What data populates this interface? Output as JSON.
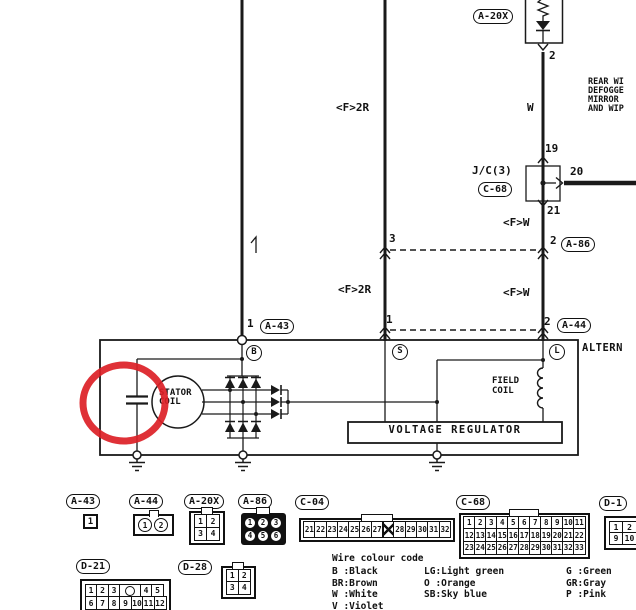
{
  "page": {
    "background": "#ffffff",
    "annotation_color": "#dc1f26",
    "line_color": "#1a1a1a"
  },
  "diagram": {
    "labels": [
      {
        "name": "connector-label-a20x",
        "text": "A-20X",
        "x": 473,
        "y": 9,
        "kind": "oval"
      },
      {
        "name": "pin-2-diode",
        "text": "2",
        "x": 549,
        "y": 50,
        "kind": "pin"
      },
      {
        "name": "wire-color-w",
        "text": "W",
        "x": 527,
        "y": 102,
        "kind": "pin"
      },
      {
        "name": "pin-19",
        "text": "19",
        "x": 545,
        "y": 143,
        "kind": "pin"
      },
      {
        "name": "junction-label-jc3",
        "text": "J/C(3)",
        "x": 472,
        "y": 165,
        "kind": "pin"
      },
      {
        "name": "connector-label-c68-top",
        "text": "C-68",
        "x": 478,
        "y": 182,
        "kind": "oval"
      },
      {
        "name": "pin-20",
        "text": "20",
        "x": 570,
        "y": 166,
        "kind": "pin"
      },
      {
        "name": "pin-21",
        "text": "21",
        "x": 547,
        "y": 205,
        "kind": "pin"
      },
      {
        "name": "wire-label-fw-upper",
        "text": "<F>W",
        "x": 503,
        "y": 217,
        "kind": "pin"
      },
      {
        "name": "pin-2-a86",
        "text": "2",
        "x": 550,
        "y": 235,
        "kind": "pin"
      },
      {
        "name": "connector-label-a86",
        "text": "A-86",
        "x": 561,
        "y": 237,
        "kind": "oval"
      },
      {
        "name": "wire-label-fw-lower",
        "text": "<F>W",
        "x": 503,
        "y": 287,
        "kind": "pin"
      },
      {
        "name": "pin-2-a44",
        "text": "2",
        "x": 544,
        "y": 316,
        "kind": "pin"
      },
      {
        "name": "connector-label-a44-top",
        "text": "A-44",
        "x": 557,
        "y": 318,
        "kind": "oval"
      },
      {
        "name": "wire-label-f2r-upper",
        "text": "<F>2R",
        "x": 336,
        "y": 102,
        "kind": "pin"
      },
      {
        "name": "pin-3",
        "text": "3",
        "x": 389,
        "y": 233,
        "kind": "pin"
      },
      {
        "name": "wire-label-f2r-lower",
        "text": "<F>2R",
        "x": 338,
        "y": 284,
        "kind": "pin"
      },
      {
        "name": "pin-1-mid",
        "text": "1",
        "x": 386,
        "y": 314,
        "kind": "pin"
      },
      {
        "name": "pin-1-a43",
        "text": "1",
        "x": 247,
        "y": 318,
        "kind": "pin"
      },
      {
        "name": "connector-label-a43-top",
        "text": "A-43",
        "x": 260,
        "y": 319,
        "kind": "oval"
      },
      {
        "name": "system-note-line1",
        "text": "REAR WI",
        "x": 588,
        "y": 78,
        "kind": "note"
      },
      {
        "name": "system-note-line2",
        "text": "DEFOGGE",
        "x": 588,
        "y": 87,
        "kind": "note"
      },
      {
        "name": "system-note-line3",
        "text": "MIRROR",
        "x": 588,
        "y": 96,
        "kind": "note"
      },
      {
        "name": "system-note-line4",
        "text": "AND WIP",
        "x": 588,
        "y": 105,
        "kind": "note"
      },
      {
        "name": "alternator-title",
        "text": "ALTERN",
        "x": 582,
        "y": 343,
        "kind": "comp"
      },
      {
        "name": "terminal-b",
        "text": "B",
        "x": 246,
        "y": 345,
        "kind": "term"
      },
      {
        "name": "terminal-s",
        "text": "S",
        "x": 392,
        "y": 344,
        "kind": "term"
      },
      {
        "name": "terminal-l",
        "text": "L",
        "x": 549,
        "y": 344,
        "kind": "term"
      },
      {
        "name": "stator-coil-label-1",
        "text": "STATOR",
        "x": 159,
        "y": 389,
        "kind": "small"
      },
      {
        "name": "stator-coil-label-2",
        "text": "COIL",
        "x": 159,
        "y": 398,
        "kind": "small"
      },
      {
        "name": "field-coil-label-1",
        "text": "FIELD",
        "x": 492,
        "y": 377,
        "kind": "small"
      },
      {
        "name": "field-coil-label-2",
        "text": "COIL",
        "x": 492,
        "y": 387,
        "kind": "small"
      },
      {
        "name": "voltage-regulator-label",
        "text": "VOLTAGE REGULATOR",
        "x": 350,
        "y": 425,
        "kind": "vr"
      }
    ]
  },
  "connectors": [
    {
      "name": "connector-a43",
      "label": "A-43",
      "label_x": 66,
      "label_y": 494,
      "shape": {
        "x": 83,
        "y": 514,
        "variant": "plain",
        "rows": [
          [
            "1"
          ]
        ],
        "cell_w": 15,
        "cell_h": 15,
        "font": 9
      }
    },
    {
      "name": "connector-a44",
      "label": "A-44",
      "label_x": 129,
      "label_y": 494,
      "shape": {
        "x": 133,
        "y": 514,
        "variant": "circles-box",
        "rows": [
          [
            "1",
            "2"
          ]
        ],
        "cell_w": 14,
        "cell_h": 14,
        "font": 8,
        "tab": true,
        "tab_w": 8
      }
    },
    {
      "name": "connector-a20x",
      "label": "A-20X",
      "label_x": 184,
      "label_y": 494,
      "shape": {
        "x": 189,
        "y": 511,
        "variant": "double-wall",
        "rows": [
          [
            "1",
            "2"
          ],
          [
            "3",
            "4"
          ]
        ],
        "cell_w": 14,
        "cell_h": 14,
        "font": 8,
        "tab": true,
        "tab_w": 10
      }
    },
    {
      "name": "connector-a86",
      "label": "A-86",
      "label_x": 238,
      "label_y": 494,
      "shape": {
        "x": 241,
        "y": 513,
        "variant": "dark-circles",
        "rows": [
          [
            "1",
            "2",
            "3"
          ],
          [
            "4",
            "5",
            "6"
          ]
        ],
        "cell_w": 12,
        "cell_h": 12,
        "font": 7.5,
        "tab": true,
        "tab_w": 12
      }
    },
    {
      "name": "connector-c04",
      "label": "C-04",
      "label_x": 295,
      "label_y": 495,
      "shape": {
        "x": 299,
        "y": 518,
        "variant": "strip",
        "rows": [
          [
            "21",
            "22",
            "23",
            "24",
            "25",
            "26",
            "27",
            "X",
            "28",
            "29",
            "30",
            "31",
            "32"
          ]
        ],
        "cell_w": 12.8,
        "cell_h": 17,
        "font": 7.5,
        "tab": true,
        "tab_w": 30
      }
    },
    {
      "name": "connector-c68",
      "label": "C-68",
      "label_x": 456,
      "label_y": 495,
      "shape": {
        "x": 459,
        "y": 513,
        "variant": "strip",
        "rows": [
          [
            "1",
            "2",
            "3",
            "4",
            "5",
            "6",
            "7",
            "8",
            "9",
            "10",
            "11"
          ],
          [
            "12",
            "13",
            "14",
            "15",
            "16",
            "17",
            "18",
            "19",
            "20",
            "21",
            "22"
          ],
          [
            "23",
            "24",
            "25",
            "26",
            "27",
            "28",
            "29",
            "30",
            "31",
            "32",
            "33"
          ]
        ],
        "cell_w": 12.5,
        "cell_h": 14,
        "font": 7.5,
        "tab": true,
        "tab_w": 28
      }
    },
    {
      "name": "connector-d1",
      "label": "D-1",
      "label_x": 599,
      "label_y": 496,
      "shape": {
        "x": 604,
        "y": 516,
        "variant": "double-wall",
        "rows": [
          [
            "1",
            "2"
          ],
          [
            "9",
            "10"
          ]
        ],
        "cell_w": 15,
        "cell_h": 13,
        "font": 8
      }
    },
    {
      "name": "connector-d21",
      "label": "D-21",
      "label_x": 76,
      "label_y": 559,
      "shape": {
        "x": 80,
        "y": 579,
        "variant": "double-wall",
        "rows": [
          [
            "1",
            "2",
            "3",
            "O",
            "4",
            "5"
          ],
          [
            "6",
            "7",
            "8",
            "9",
            "10",
            "11",
            "12"
          ]
        ],
        "cell_w": 13,
        "cell_h": 14,
        "font": 8
      }
    },
    {
      "name": "connector-d28",
      "label": "D-28",
      "label_x": 178,
      "label_y": 560,
      "shape": {
        "x": 221,
        "y": 566,
        "variant": "double-wall",
        "rows": [
          [
            "1",
            "2"
          ],
          [
            "3",
            "4"
          ]
        ],
        "cell_w": 13.5,
        "cell_h": 13.5,
        "font": 8,
        "tab": true,
        "tab_w": 10
      }
    }
  ],
  "legend": {
    "title": "Wire colour code",
    "columns": [
      [
        "B :Black",
        "BR:Brown",
        "W :White",
        "V :Violet"
      ],
      [
        "LG:Light green",
        "O :Orange",
        "SB:Sky blue"
      ],
      [
        "G :Green",
        "GR:Gray",
        "P :Pink"
      ]
    ]
  }
}
